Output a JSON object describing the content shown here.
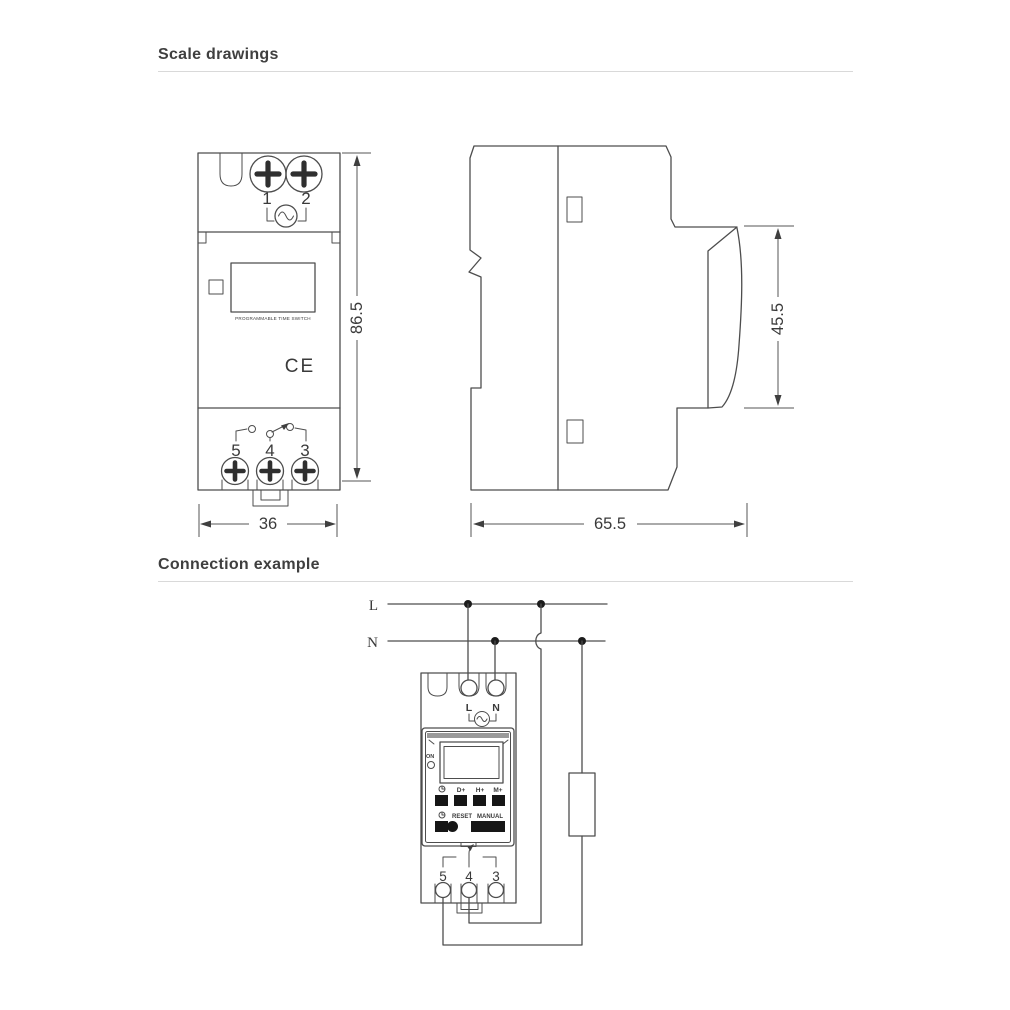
{
  "page": {
    "background": "#ffffff"
  },
  "colors": {
    "line": "#4d4d4d",
    "text": "#3a3a3a",
    "dark_fill": "#1c1c1c",
    "rule": "#d9d9d9",
    "panel_band": "#9a9a9a"
  },
  "sections": {
    "scale": {
      "title": "Scale drawings"
    },
    "connection": {
      "title": "Connection example"
    }
  },
  "front_view": {
    "top_terminal_labels": [
      "1",
      "2"
    ],
    "bottom_terminal_labels": [
      "5",
      "4",
      "3"
    ],
    "display_caption": "PROGRAMMABLE TIME SWITCH",
    "ce_mark": "CE",
    "dim_height": "86.5",
    "dim_width": "36"
  },
  "side_view": {
    "dim_rail": "45.5",
    "dim_depth": "65.5"
  },
  "connection": {
    "live_label": "L",
    "neutral_label": "N",
    "device": {
      "input_labels": [
        "L",
        "N"
      ],
      "indicator_label": "ON",
      "key_labels": [
        "D+",
        "H+",
        "M+"
      ],
      "reset_label": "RESET",
      "manual_label": "MANUAL",
      "output_labels": [
        "5",
        "4",
        "3"
      ]
    }
  }
}
